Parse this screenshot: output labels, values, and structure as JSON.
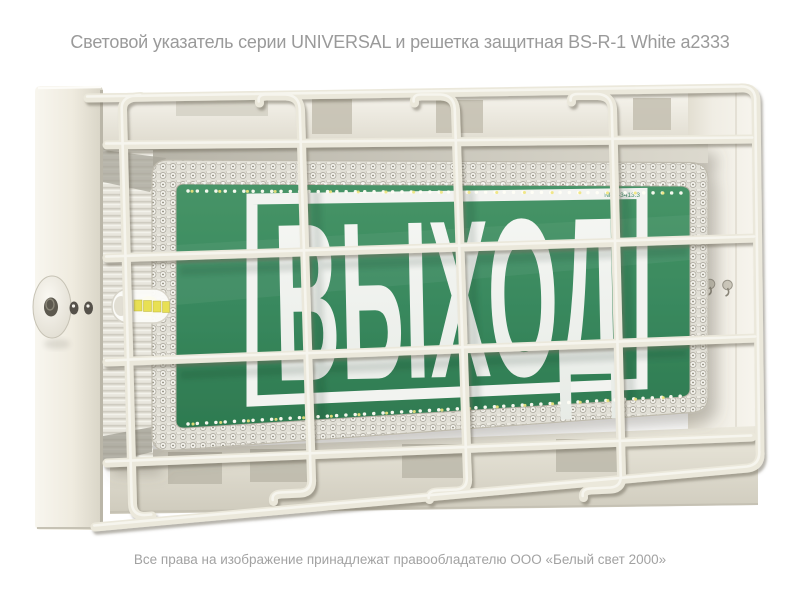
{
  "caption": {
    "title": "Световой указатель серии UNIVERSAL и решетка защитная BS-R-1 White а2333",
    "copyright": "Все права на изображение принадлежат правообладателю ООО «Белый свет 2000»"
  },
  "sign": {
    "text": "ВЫХОД",
    "model_label": "NPU-3413.3"
  },
  "colors": {
    "sign_green": "#3a8a5f",
    "sign_green_light": "#46936b",
    "sign_green_dark": "#2e7a50",
    "sign_letters": "#f1f3f0",
    "wire_cream": "#ebe8db",
    "body_cream": "#f3f0e7",
    "caption_gray": "#9a9a9a"
  }
}
